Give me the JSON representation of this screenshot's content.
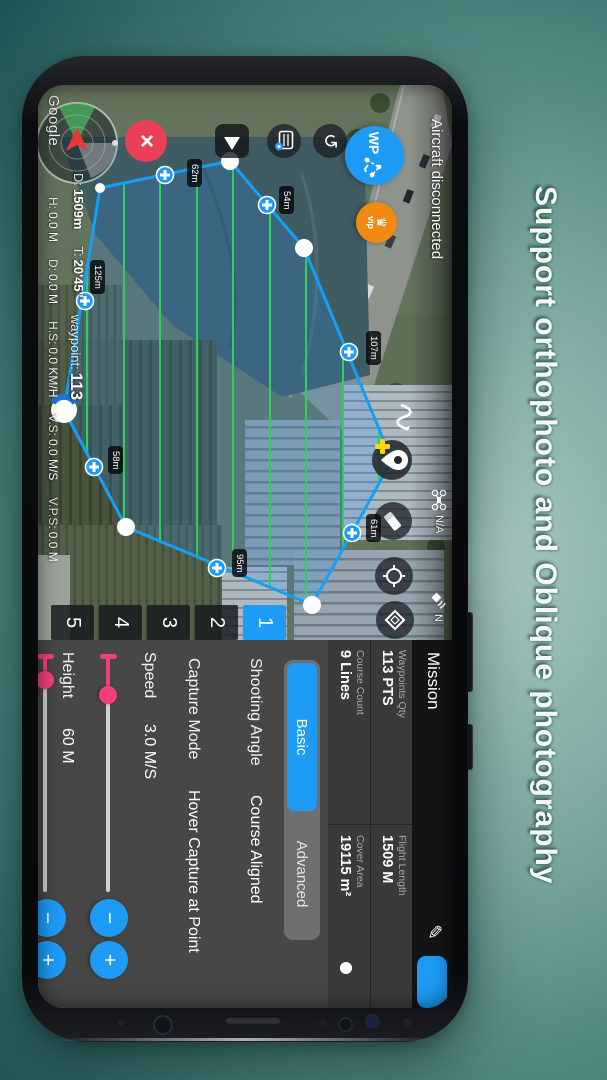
{
  "caption": "Support orthophoto and Oblique photography",
  "colors": {
    "accent_blue": "#1e9bf5",
    "slider_pink": "#f0417c",
    "vip_orange": "#f08a12",
    "close_red": "#e94057",
    "scanline_green": "#2ed157",
    "path_blue": "#14a0f6",
    "background_teal": "#4b837d"
  },
  "status_bar": {
    "title": "Aircraft disconnected",
    "aircraft_status": "N/A",
    "satellite_count": "N"
  },
  "toolbar": {
    "wp": "WP",
    "vip": "vip"
  },
  "map": {
    "watermark": "Google",
    "scan_line_count": 9,
    "edge_labels": [
      {
        "text": "62m"
      },
      {
        "text": "54m"
      },
      {
        "text": "107m"
      },
      {
        "text": "61m"
      },
      {
        "text": "95m"
      },
      {
        "text": "58m"
      },
      {
        "text": "125m"
      }
    ]
  },
  "telemetry": {
    "row1": [
      {
        "label": "D:",
        "value": "1509m"
      },
      {
        "label": "T:",
        "value": "20'45\""
      },
      {
        "label": "waypoint:",
        "value": "113"
      }
    ],
    "row2": [
      {
        "label": "H:",
        "value": "0.0 M"
      },
      {
        "label": "D:",
        "value": "0.0 M"
      },
      {
        "label": "H.S:",
        "value": "0.0 KM/H"
      },
      {
        "label": "V.S:",
        "value": "0.0 M/S"
      },
      {
        "label": "V.P.S:",
        "value": "0.0 M"
      }
    ]
  },
  "panel": {
    "title": "Mission",
    "tabs": [
      "1",
      "2",
      "3",
      "4",
      "5"
    ],
    "active_tab": "1",
    "stats": [
      {
        "label": "Waypoints Qty",
        "value": "113 PTS"
      },
      {
        "label": "Flight Length",
        "value": "1509 M"
      },
      {
        "label": "Course Count",
        "value": "9 Lines"
      },
      {
        "label": "Cover Area",
        "value": "19115 m²"
      }
    ],
    "modes": {
      "basic": "Basic",
      "advanced": "Advanced",
      "selected": "Basic"
    },
    "rows": [
      {
        "label": "Shooting Angle",
        "value": "Course Aligned"
      },
      {
        "label": "Capture Mode",
        "value": "Hover Capture at Point"
      }
    ],
    "sliders": [
      {
        "label": "Speed",
        "value": "3.0 M/S"
      },
      {
        "label": "Height",
        "value": "60 M"
      }
    ],
    "minus": "−",
    "plus": "+"
  }
}
